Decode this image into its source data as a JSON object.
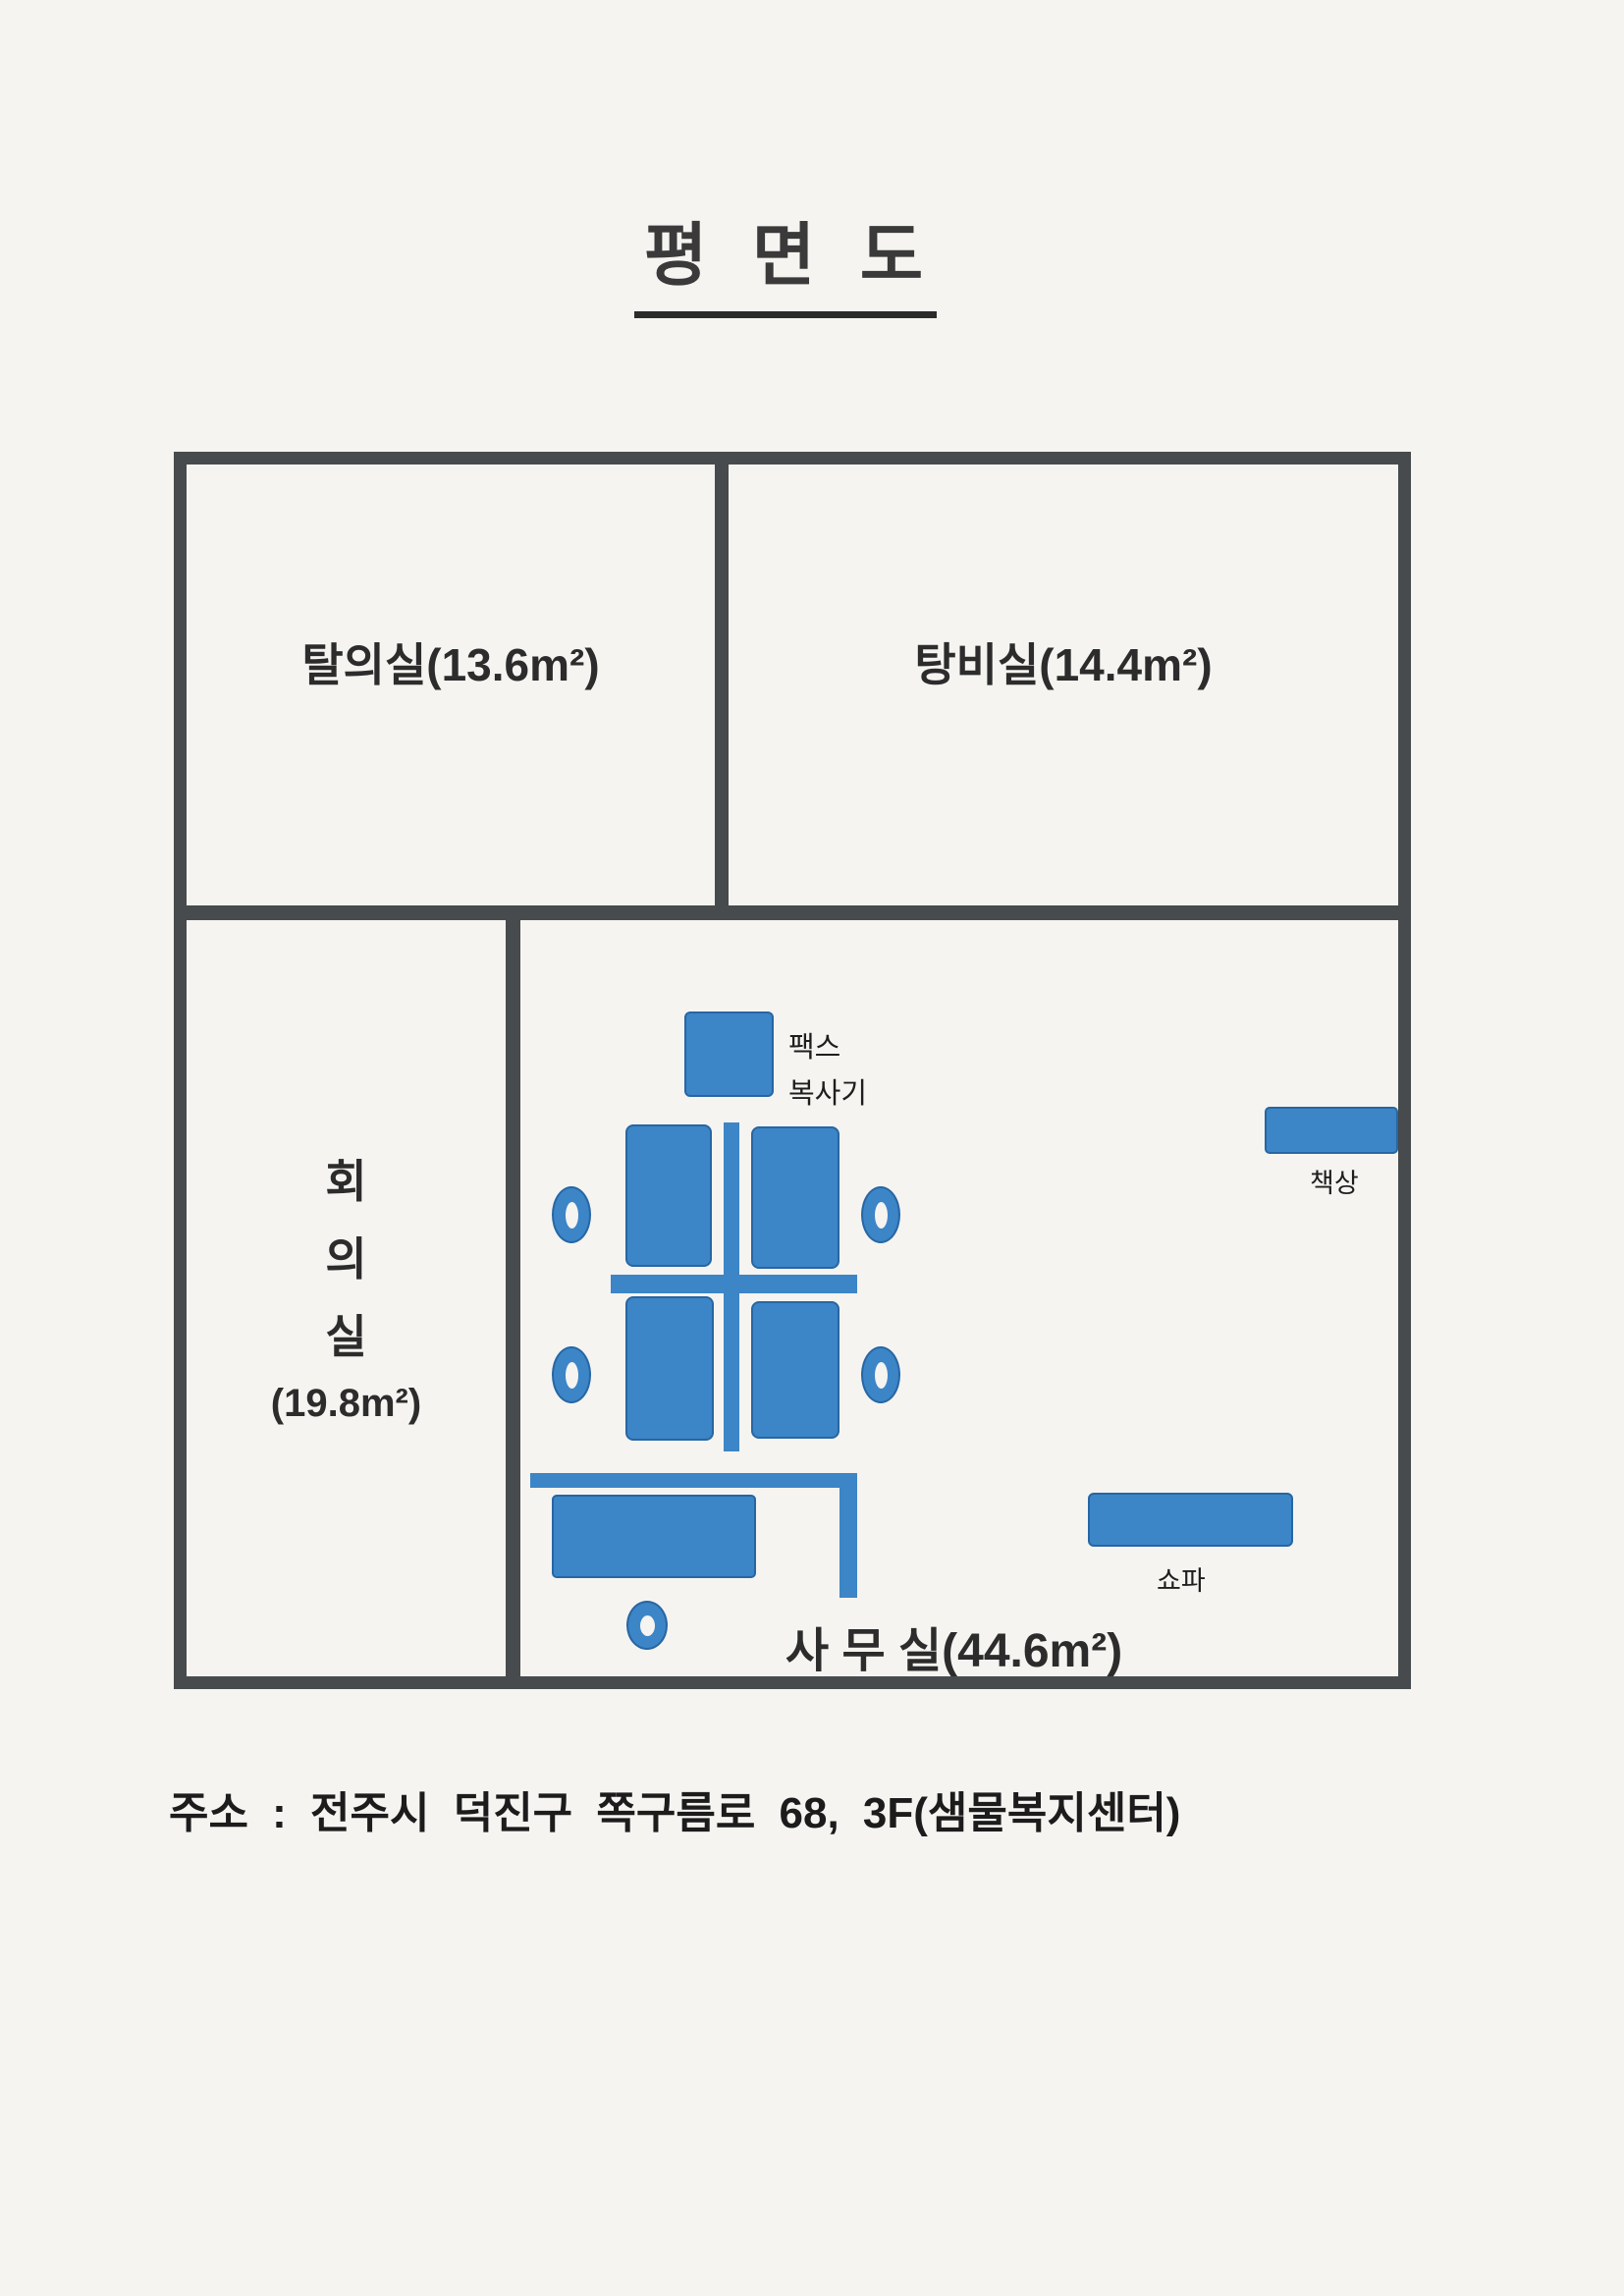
{
  "title": "평 면 도",
  "rooms": {
    "dressing_label": "탈의실(13.6m²)",
    "pantry_label": "탕비실(14.4m²)",
    "meeting": {
      "char1": "회",
      "char2": "의",
      "char3": "실",
      "area": "(19.8m²)"
    },
    "office_label": "사 무 실(44.6m²)"
  },
  "furniture": {
    "fax_line1": "팩스",
    "fax_line2": "복사기",
    "desk_label": "책상",
    "sofa_label": "쇼파"
  },
  "footer": {
    "address": "주소 : 전주시 덕진구 쪽구름로 68, 3F(샘물복지센터)"
  },
  "colors": {
    "furniture_blue": "#3c85c7",
    "furniture_border": "#2766a3",
    "wall_gray": "#474b4d",
    "paper": "#f5f4f1",
    "ink": "#2d2d2d"
  }
}
